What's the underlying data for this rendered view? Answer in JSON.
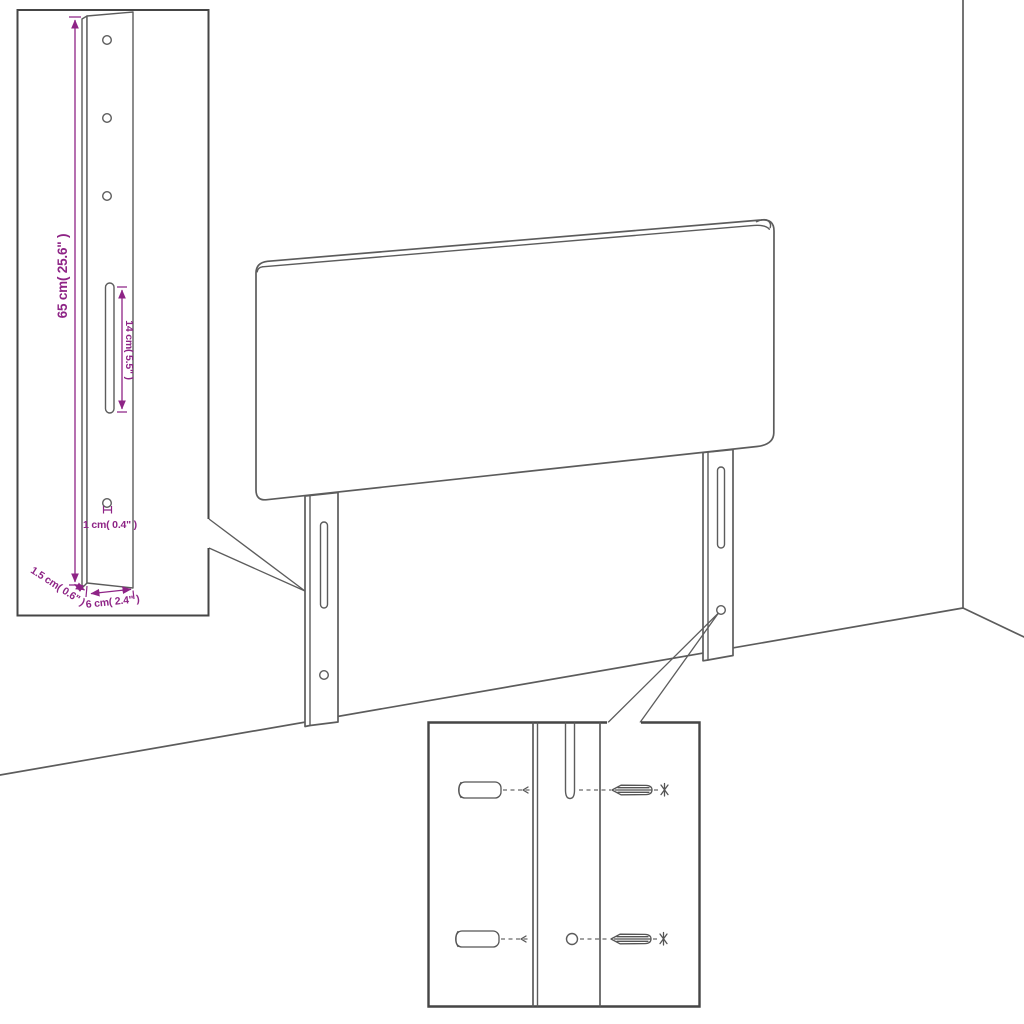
{
  "colors": {
    "line": "#5C5C5C",
    "box_border": "#454545",
    "dimension": "#8E2486",
    "background": "#FFFFFF"
  },
  "bracket_detail": {
    "dim_height": "65 cm( 25.6\" )",
    "dim_slot": "14 cm( 5.5\" )",
    "dim_hole": "1 cm( 0.4\" )",
    "dim_thickness": "1.5 cm( 0.6\" )",
    "dim_width": "6 cm( 2.4\" )"
  }
}
